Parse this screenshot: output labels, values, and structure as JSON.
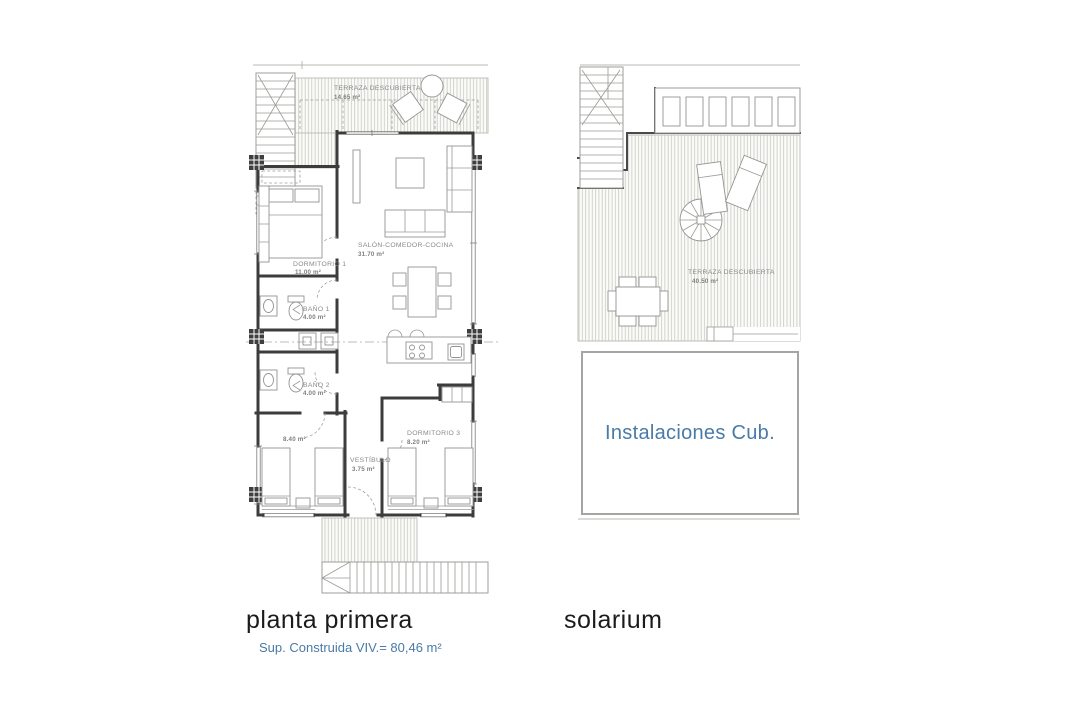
{
  "colors": {
    "accent_blue": "#4a7aa6",
    "wall": "#3c3c3c",
    "label_gray": "#8a8a8a",
    "title_black": "#1b1b1b",
    "hatch_line": "#c5c5c0"
  },
  "plans": {
    "planta_primera": {
      "title": "planta primera",
      "subtitle": "Sup. Construida VIV.= 80,46 m²",
      "rooms": {
        "terraza": {
          "name": "TERRAZA DESCUBIERTA",
          "area": "14.65 m²"
        },
        "salon": {
          "name": "SALÓN-COMEDOR-COCINA",
          "area": "31.70 m²"
        },
        "dormitorio1": {
          "name": "DORMITORIO 1",
          "area": "11.00 m²"
        },
        "bano1": {
          "name": "BAÑO 1",
          "area": "4.00 m²"
        },
        "bano2": {
          "name": "BAÑO 2",
          "area": "4.00 m²"
        },
        "dormitorio2": {
          "area": "8.40 m²"
        },
        "dormitorio3": {
          "name": "DORMITORIO 3",
          "area": "8.20 m²"
        },
        "vestibulo": {
          "name": "VESTÍBULO",
          "area": "3.75 m²"
        }
      }
    },
    "solarium": {
      "title": "solarium",
      "rooms": {
        "terraza": {
          "name": "TERRAZA DESCUBIERTA",
          "area": "40.50 m²"
        },
        "instalaciones": {
          "name": "Instalaciones Cub."
        }
      }
    }
  }
}
